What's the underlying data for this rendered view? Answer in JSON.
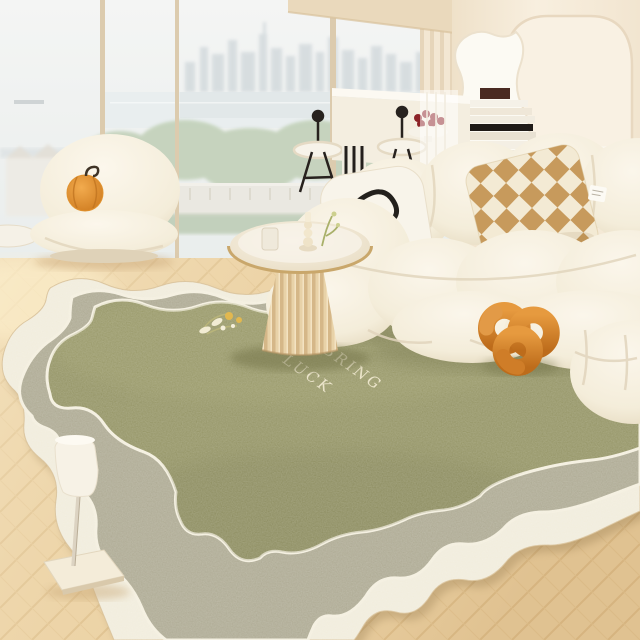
{
  "image": {
    "kind": "lifestyle product photograph",
    "subject": "scalloped layered leather area rug in a bright cream living room with city-view windows"
  },
  "rug": {
    "style": "three-layer scalloped-edge leather rug",
    "text": {
      "line1": "BRING",
      "line2": "LUCK"
    },
    "motif": "small yellow wildflower sprig"
  },
  "palette": {
    "rug_center": "#8d8d5b",
    "rug_middle": "#a8a48c",
    "rug_outer": "#f0ebda",
    "rug_outline": "#f3eedd",
    "wood_floor": "#ecd4a8",
    "wall": "#f6ecdc",
    "window_glass": "#f0f2f1",
    "window_frame": "#dccbae",
    "sofa_cream": "#f6f0e2",
    "armchair_cream": "#f7f1e3",
    "table_top": "#f4eee1",
    "table_rim": "#c9a76b",
    "pedestal": "#e8d2a8",
    "knot_pillow": "#cf7d28",
    "pumpkin_pillow": "#e0922f",
    "checker_tan": "#c79a5c",
    "checker_cream": "#f3ead4",
    "cherries": "#8c2328",
    "trees": "#c3d1ba",
    "skyline": "#c2ccd1",
    "lamp_shade": "#f7f2e6"
  },
  "objects": [
    "scalloped layered rug",
    "cream modular sofa",
    "checkerboard pillow",
    "black line-art pillow",
    "orange knot pillow",
    "puffy cream armchair",
    "pumpkin pillow",
    "round fluted pedestal table",
    "candlestick and glass",
    "slim floor lamp",
    "herringbone wood floor",
    "floor-to-ceiling windows",
    "white vanity desk with books",
    "wavy mirror",
    "black-frame stools",
    "bowl of cherries"
  ]
}
